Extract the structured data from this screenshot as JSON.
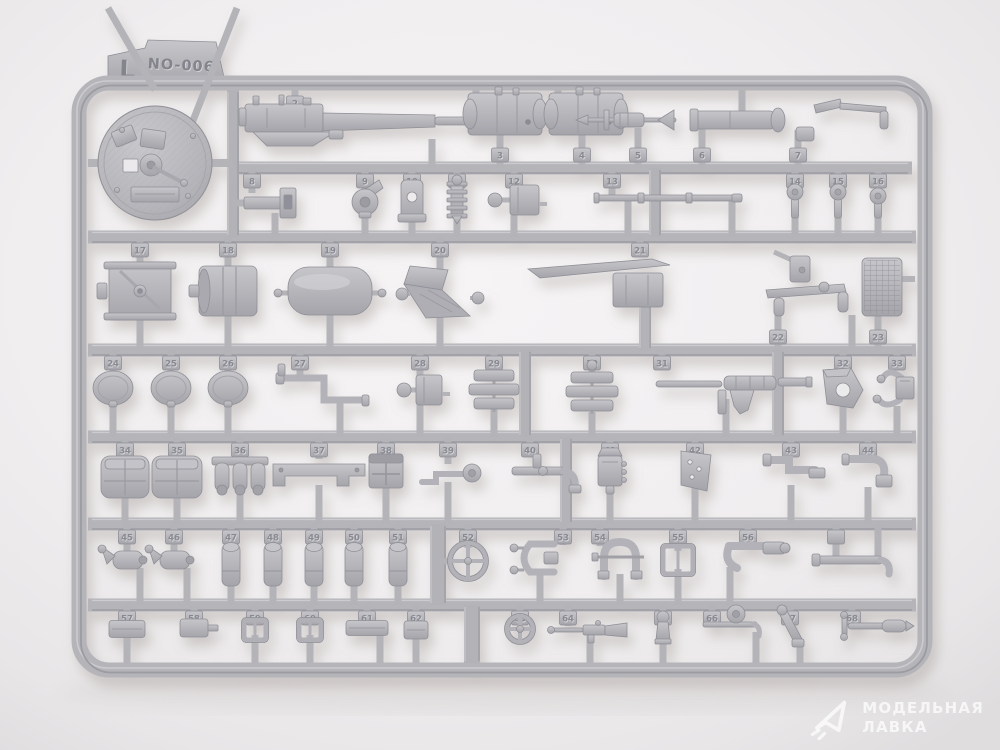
{
  "photo": {
    "subject": "injection-molded model kit sprue on light background",
    "sprue_letter": "L",
    "sprue_code": "NO-006",
    "colors": {
      "plastic": "#b5b5ba",
      "plastic_light": "#c9c9cd",
      "plastic_dark": "#8f8f96",
      "background": "#efedee",
      "shadow": "#9a918c"
    }
  },
  "watermark": {
    "line1": "МОДЕЛЬНАЯ",
    "line2": "ЛАВКА",
    "logo": "paper-plane-triangle",
    "color": "#ffffff"
  },
  "sprue": {
    "frame": {
      "x": 79,
      "y": 83,
      "w": 846,
      "h": 587,
      "r": 30,
      "stroke": 15
    },
    "label_tab": {
      "letter": "L",
      "code": "NO-006"
    },
    "rails": [
      {
        "y": 168,
        "x1": 233,
        "x2": 912
      },
      {
        "y": 237,
        "x1": 88,
        "x2": 916
      },
      {
        "y": 350,
        "x1": 88,
        "x2": 916
      },
      {
        "y": 437,
        "x1": 88,
        "x2": 916
      },
      {
        "y": 524,
        "x1": 88,
        "x2": 916
      },
      {
        "y": 605,
        "x1": 88,
        "x2": 916
      }
    ],
    "runners": [
      {
        "x": 233,
        "y1": 90,
        "y2": 237
      },
      {
        "x": 655,
        "y1": 168,
        "y2": 237
      },
      {
        "x": 645,
        "y1": 300,
        "y2": 350
      },
      {
        "x": 525,
        "y1": 350,
        "y2": 437
      },
      {
        "x": 778,
        "y1": 350,
        "y2": 437
      },
      {
        "x": 566,
        "y1": 437,
        "y2": 524
      },
      {
        "x": 438,
        "y1": 524,
        "y2": 605,
        "wd": 16
      },
      {
        "x": 472,
        "y1": 605,
        "y2": 663,
        "wd": 16
      }
    ],
    "parts": [
      {
        "l": "1",
        "n": "turret-roof-disc",
        "s": "disc",
        "x": 155,
        "y": 163,
        "w": 114,
        "h": 114
      },
      {
        "l": "2",
        "n": "machine-gun",
        "s": "mg",
        "x": 365,
        "y": 122,
        "w": 240,
        "h": 44,
        "su": 90,
        "sux": 295,
        "sd": 168,
        "sdx": 432,
        "tab": "u"
      },
      {
        "l": "3",
        "n": "gun-housing",
        "s": "housing",
        "x": 505,
        "y": 114,
        "w": 74,
        "h": 42,
        "su": 90,
        "sux": 476,
        "sd": 168,
        "sdx": 500,
        "tab": "d"
      },
      {
        "l": "4",
        "n": "gun-housing",
        "s": "housing",
        "x": 586,
        "y": 114,
        "w": 74,
        "h": 42,
        "su": 90,
        "sux": 558,
        "sd": 168,
        "sdx": 582,
        "tab": "d"
      },
      {
        "l": "5",
        "n": "finned-valve",
        "s": "dagger",
        "x": 630,
        "y": 120,
        "w": 92,
        "h": 26,
        "sd": 168,
        "sdx": 638,
        "tab": "d"
      },
      {
        "l": "6",
        "n": "cylinder-rod",
        "s": "cylh",
        "x": 740,
        "y": 120,
        "w": 96,
        "h": 18,
        "su": 90,
        "sux": 742,
        "sd": 168,
        "sdx": 702,
        "tab": "d"
      },
      {
        "l": "7",
        "n": "hammer-bracket",
        "s": "hammer",
        "x": 852,
        "y": 115,
        "w": 76,
        "h": 40,
        "sd": 168,
        "sdx": 798,
        "tab": "d"
      },
      {
        "l": "8",
        "n": "mount-bracket",
        "s": "bracket",
        "x": 272,
        "y": 203,
        "w": 56,
        "h": 30,
        "su": 168,
        "sux": 252,
        "sd": 237,
        "sdx": 275,
        "tab": "u"
      },
      {
        "l": "9",
        "n": "pulley-arm",
        "s": "pulley",
        "x": 365,
        "y": 202,
        "w": 34,
        "h": 34,
        "su": 168,
        "sd": 237,
        "tab": "u"
      },
      {
        "l": "10",
        "n": "eye-plate",
        "s": "plateh",
        "x": 412,
        "y": 201,
        "w": 22,
        "h": 42,
        "su": 168,
        "sd": 237,
        "tab": "u"
      },
      {
        "l": "11",
        "n": "finned-cylinder",
        "s": "finv",
        "x": 457,
        "y": 200,
        "w": 20,
        "h": 48,
        "su": 168,
        "sd": 237,
        "tab": "u"
      },
      {
        "l": "12",
        "n": "valve-box",
        "s": "boxball",
        "x": 514,
        "y": 200,
        "w": 50,
        "h": 30,
        "su": 168,
        "sd": 237,
        "tab": "u"
      },
      {
        "l": "13",
        "n": "cleaning-rod",
        "s": "rodh",
        "x": 668,
        "y": 198,
        "w": 148,
        "h": 10,
        "su": 168,
        "sux": 612,
        "sd": 237,
        "sdx": 628,
        "sd2x": 732,
        "tab": "u"
      },
      {
        "l": "14",
        "n": "knob",
        "s": "knob",
        "x": 795,
        "y": 201,
        "w": 20,
        "h": 34,
        "su": 168,
        "sd": 237,
        "tab": "u"
      },
      {
        "l": "15",
        "n": "knob",
        "s": "knob",
        "x": 838,
        "y": 201,
        "w": 18,
        "h": 34,
        "su": 168,
        "sd": 237,
        "tab": "u"
      },
      {
        "l": "16",
        "n": "bolt-knob",
        "s": "knob",
        "x": 878,
        "y": 203,
        "w": 18,
        "h": 30,
        "su": 168,
        "sd": 237,
        "tab": "u"
      },
      {
        "l": "17",
        "n": "winch-drum",
        "s": "drum",
        "x": 140,
        "y": 291,
        "w": 62,
        "h": 58,
        "su": 237,
        "sd": 350,
        "tab": "u"
      },
      {
        "l": "18",
        "n": "roller-drum",
        "s": "drum2",
        "x": 228,
        "y": 291,
        "w": 58,
        "h": 50,
        "su": 237,
        "sd": 350,
        "tab": "u"
      },
      {
        "l": "19",
        "n": "stowage-tank",
        "s": "tank",
        "x": 330,
        "y": 291,
        "w": 84,
        "h": 48,
        "su": 237,
        "sd": 350,
        "tab": "u"
      },
      {
        "l": "20",
        "n": "angled-seat",
        "s": "seat",
        "x": 440,
        "y": 292,
        "w": 62,
        "h": 56,
        "su": 237,
        "sd": 350,
        "tab": "u"
      },
      {
        "l": "21",
        "n": "fender-blade",
        "s": "blade",
        "x": 612,
        "y": 283,
        "w": 165,
        "h": 62,
        "su": 237,
        "sux": 640,
        "sd": 350,
        "sdx": 646,
        "tab": "u"
      },
      {
        "l": "22",
        "n": "gun-mount-arm",
        "s": "mountarm",
        "x": 800,
        "y": 288,
        "w": 104,
        "h": 64,
        "sd": 350,
        "sdx": 778,
        "sd2x": 852,
        "tab": "d"
      },
      {
        "l": "23",
        "n": "mesh-drum",
        "s": "grille",
        "x": 882,
        "y": 287,
        "w": 40,
        "h": 58,
        "sd": 350,
        "sdx": 878,
        "tab": "d"
      },
      {
        "l": "24",
        "n": "oval-hatch",
        "s": "oval",
        "x": 113,
        "y": 388,
        "w": 40,
        "h": 34,
        "su": 350,
        "sd": 437,
        "tab": "u"
      },
      {
        "l": "25",
        "n": "oval-hatch",
        "s": "oval",
        "x": 171,
        "y": 388,
        "w": 40,
        "h": 34,
        "su": 350,
        "sd": 437,
        "tab": "u"
      },
      {
        "l": "26",
        "n": "oval-hatch",
        "s": "oval",
        "x": 228,
        "y": 388,
        "w": 40,
        "h": 34,
        "su": 350,
        "sd": 437,
        "tab": "u"
      },
      {
        "l": "27",
        "n": "z-pipe",
        "s": "zpipe",
        "x": 322,
        "y": 390,
        "w": 86,
        "h": 36,
        "su": 350,
        "sux": 300,
        "sd": 437,
        "sdx": 340,
        "tab": "u"
      },
      {
        "l": "28",
        "n": "pump-box",
        "s": "boxball",
        "x": 420,
        "y": 390,
        "w": 44,
        "h": 30,
        "su": 350,
        "sd": 437,
        "tab": "u"
      },
      {
        "l": "29",
        "n": "plate-stack",
        "s": "stack",
        "x": 494,
        "y": 390,
        "w": 40,
        "h": 48,
        "su": 350,
        "sd": 437,
        "tab": "u"
      },
      {
        "l": "30",
        "n": "plate-stack",
        "s": "stack",
        "x": 592,
        "y": 392,
        "w": 42,
        "h": 50,
        "su": 350,
        "sd": 437,
        "tab": "u"
      },
      {
        "l": "31",
        "n": "shrouded-gun",
        "s": "mg2",
        "x": 732,
        "y": 384,
        "w": 152,
        "h": 40,
        "su": 350,
        "sux": 662,
        "sd": 437,
        "sdx": 726,
        "tab": "u"
      },
      {
        "l": "32",
        "n": "angle-bracket",
        "s": "penthole",
        "x": 843,
        "y": 388,
        "w": 42,
        "h": 40,
        "su": 350,
        "sd": 437,
        "tab": "u"
      },
      {
        "l": "33",
        "n": "hook-mount",
        "s": "hookmount",
        "x": 904,
        "y": 388,
        "w": 40,
        "h": 46,
        "su": 350,
        "sux": 897,
        "sd": 437,
        "sdx": 897,
        "tab": "u"
      },
      {
        "l": "34",
        "n": "stowage-pouch",
        "s": "pouch",
        "x": 125,
        "y": 477,
        "w": 48,
        "h": 42,
        "su": 437,
        "sd": 524,
        "tab": "u"
      },
      {
        "l": "35",
        "n": "stowage-pouch",
        "s": "pouch",
        "x": 177,
        "y": 477,
        "w": 50,
        "h": 42,
        "su": 437,
        "sd": 524,
        "tab": "u"
      },
      {
        "l": "36",
        "n": "triple-cylinder",
        "s": "tricyl",
        "x": 240,
        "y": 475,
        "w": 56,
        "h": 36,
        "su": 437,
        "sd": 524,
        "tab": "u"
      },
      {
        "l": "37",
        "n": "flat-bracket",
        "s": "hplate",
        "x": 319,
        "y": 472,
        "w": 92,
        "h": 36,
        "su": 437,
        "sd": 524,
        "tab": "u"
      },
      {
        "l": "38",
        "n": "cross-box",
        "s": "crossbox",
        "x": 386,
        "y": 471,
        "w": 34,
        "h": 34,
        "su": 437,
        "sd": 524,
        "tab": "u"
      },
      {
        "l": "39",
        "n": "pipe-and-disc",
        "s": "pipedisc",
        "x": 448,
        "y": 473,
        "w": 56,
        "h": 28,
        "su": 437,
        "sd": 524,
        "tab": "u"
      },
      {
        "l": "40",
        "n": "manifold-arm",
        "s": "manifold",
        "x": 545,
        "y": 471,
        "w": 66,
        "h": 42,
        "su": 437,
        "sux": 530,
        "sd": 524,
        "sdx": 566,
        "tab": "u"
      },
      {
        "l": "41",
        "n": "device-box",
        "s": "device",
        "x": 610,
        "y": 472,
        "w": 30,
        "h": 40,
        "su": 437,
        "sd": 524,
        "tab": "u"
      },
      {
        "l": "42",
        "n": "hole-plate",
        "s": "holeplate",
        "x": 695,
        "y": 471,
        "w": 34,
        "h": 42,
        "su": 437,
        "sd": 524,
        "tab": "u"
      },
      {
        "l": "43",
        "n": "z-bracket",
        "s": "zbracket",
        "x": 791,
        "y": 470,
        "w": 54,
        "h": 40,
        "su": 437,
        "sd": 524,
        "tab": "u"
      },
      {
        "l": "44",
        "n": "elbow-pipe",
        "s": "lpipe",
        "x": 868,
        "y": 471,
        "w": 50,
        "h": 42,
        "su": 437,
        "sd": 524,
        "tab": "u"
      },
      {
        "l": "45",
        "n": "elbow-cylinder",
        "s": "cylelbow",
        "x": 127,
        "y": 560,
        "w": 44,
        "h": 26,
        "su": 524,
        "sd": 605,
        "sdx": 140,
        "tab": "u"
      },
      {
        "l": "46",
        "n": "elbow-cylinder",
        "s": "cylelbow",
        "x": 174,
        "y": 560,
        "w": 44,
        "h": 26,
        "su": 524,
        "sd": 605,
        "sdx": 187,
        "tab": "u"
      },
      {
        "l": "47",
        "n": "small-cylinder",
        "s": "cylv",
        "x": 231,
        "y": 565,
        "w": 20,
        "h": 42,
        "su": 524,
        "sd": 605,
        "tab": "u"
      },
      {
        "l": "48",
        "n": "small-cylinder",
        "s": "cylv",
        "x": 273,
        "y": 565,
        "w": 20,
        "h": 42,
        "su": 524,
        "sd": 605,
        "tab": "u"
      },
      {
        "l": "49",
        "n": "small-cylinder",
        "s": "cylv",
        "x": 314,
        "y": 565,
        "w": 20,
        "h": 42,
        "su": 524,
        "sd": 605,
        "tab": "u"
      },
      {
        "l": "50",
        "n": "small-cylinder",
        "s": "cylv",
        "x": 354,
        "y": 565,
        "w": 20,
        "h": 42,
        "su": 524,
        "sd": 605,
        "tab": "u"
      },
      {
        "l": "51",
        "n": "small-cylinder",
        "s": "cylv",
        "x": 398,
        "y": 565,
        "w": 20,
        "h": 42,
        "su": 524,
        "sd": 605,
        "tab": "u"
      },
      {
        "l": "52",
        "n": "handwheel",
        "s": "wheel",
        "x": 468,
        "y": 561,
        "w": 36,
        "h": 36,
        "su": 524,
        "stub": "left",
        "tab": "u"
      },
      {
        "l": "53",
        "n": "clamp",
        "s": "clamp",
        "x": 538,
        "y": 558,
        "w": 46,
        "h": 36,
        "su": 524,
        "sux": 563,
        "sd": 605,
        "sdx": 540,
        "tab": "u"
      },
      {
        "l": "54",
        "n": "horseshoe-guard",
        "s": "ushape",
        "x": 620,
        "y": 560,
        "w": 48,
        "h": 38,
        "su": 524,
        "sux": 600,
        "sd": 605,
        "sdx": 620,
        "tab": "u"
      },
      {
        "l": "55",
        "n": "buckle",
        "s": "buckle",
        "x": 678,
        "y": 560,
        "w": 30,
        "h": 28,
        "su": 524,
        "sd": 605,
        "tab": "u"
      },
      {
        "l": "56",
        "n": "grip-hook",
        "s": "grip",
        "x": 755,
        "y": 556,
        "w": 58,
        "h": 32,
        "su": 524,
        "sux": 748,
        "sd": 605,
        "sdx": 730,
        "tab": "u"
      },
      {
        "l": "",
        "n": "long-pipe",
        "s": "longpipe",
        "x": 856,
        "y": 562,
        "w": 78,
        "h": 22,
        "su": 524,
        "sux": 836,
        "su2x": 878,
        "tab": "u"
      },
      {
        "l": "57",
        "n": "small-box",
        "s": "block",
        "x": 127,
        "y": 629,
        "w": 36,
        "h": 17,
        "su": 605,
        "sd": 663,
        "tab": "u"
      },
      {
        "l": "58",
        "n": "stub-box",
        "s": "blockstub",
        "x": 194,
        "y": 628,
        "w": 28,
        "h": 18,
        "su": 605,
        "tab": "u"
      },
      {
        "l": "59",
        "n": "buckle",
        "s": "buckle",
        "x": 255,
        "y": 630,
        "w": 22,
        "h": 20,
        "su": 605,
        "sd": 663,
        "tab": "u"
      },
      {
        "l": "60",
        "n": "buckle",
        "s": "buckle",
        "x": 310,
        "y": 630,
        "w": 22,
        "h": 20,
        "su": 605,
        "sd": 663,
        "tab": "u"
      },
      {
        "l": "61",
        "n": "long-box",
        "s": "block",
        "x": 367,
        "y": 628,
        "w": 42,
        "h": 15,
        "su": 605,
        "sd": 663,
        "sdx": 380,
        "tab": "u"
      },
      {
        "l": "62",
        "n": "small-box",
        "s": "block",
        "x": 416,
        "y": 630,
        "w": 24,
        "h": 18,
        "su": 605,
        "sd": 663,
        "tab": "u"
      },
      {
        "l": "63",
        "n": "handwheel-small",
        "s": "wheel",
        "x": 520,
        "y": 629,
        "w": 26,
        "h": 26,
        "su": 605,
        "tab": "u"
      },
      {
        "l": "64",
        "n": "rifle",
        "s": "rifle",
        "x": 590,
        "y": 630,
        "w": 74,
        "h": 18,
        "su": 605,
        "sux": 568,
        "sd": 663,
        "sdx": 590,
        "tab": "u"
      },
      {
        "l": "65",
        "n": "grip-post",
        "s": "figure",
        "x": 663,
        "y": 628,
        "w": 20,
        "h": 32,
        "su": 605,
        "sd": 663,
        "tab": "u"
      },
      {
        "l": "66",
        "n": "rod-with-disc",
        "s": "roddisc",
        "x": 730,
        "y": 624,
        "w": 54,
        "h": 26,
        "su": 605,
        "sux": 712,
        "sd": 663,
        "sdx": 756,
        "tab": "u"
      },
      {
        "l": "67",
        "n": "angled-lever",
        "s": "lever",
        "x": 790,
        "y": 627,
        "w": 30,
        "h": 34,
        "su": 605,
        "sd": 663,
        "sdx": 800,
        "tab": "u"
      },
      {
        "l": "68",
        "n": "handle-rod",
        "s": "handlerod",
        "x": 874,
        "y": 626,
        "w": 68,
        "h": 20,
        "su": 605,
        "sux": 852,
        "tab": "u"
      }
    ]
  }
}
